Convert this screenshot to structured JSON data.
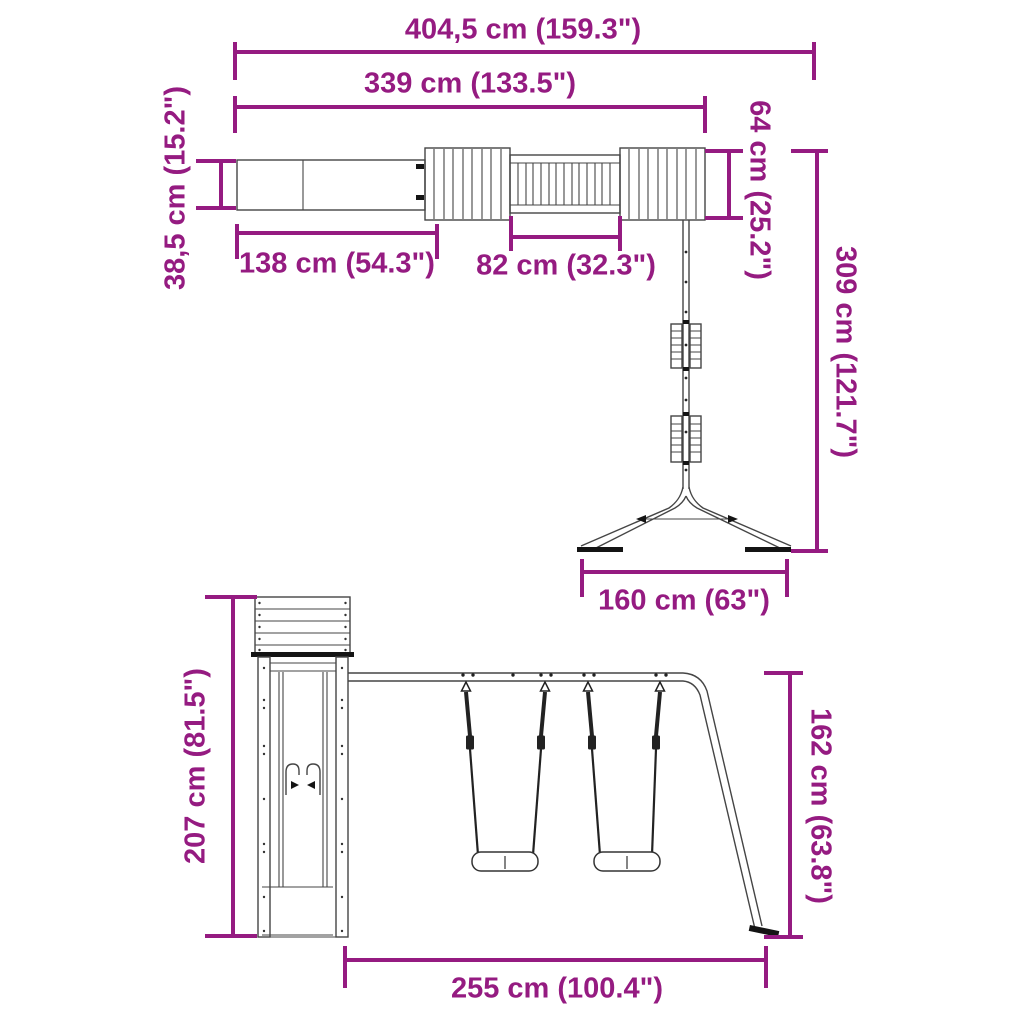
{
  "diagram": {
    "type": "product-dimension-diagram",
    "subject": "wooden playset with monkey-bar swing beam, slide tower and double swing set",
    "views": [
      "monkey-bar-beam-with-a-frame-side",
      "tower-slide-and-swing-set-front"
    ]
  },
  "colors": {
    "dimension": "#951b81",
    "structure": "#454545",
    "dark": "#141414",
    "background": "#ffffff"
  },
  "labels": {
    "total_width": "404,5 cm (159.3\")",
    "beam_span": "339 cm (133.5\")",
    "beam_depth": "38,5 cm (15.2\")",
    "left_beam_length": "138 cm (54.3\")",
    "bridge_length": "82 cm (32.3\")",
    "beam_thickness": "64 cm (25.2\")",
    "frame_height": "309 cm (121.7\")",
    "base_width": "160 cm (63\")",
    "tower_height": "207 cm (81.5\")",
    "swing_frame_height": "162 cm (63.8\")",
    "swing_frame_width": "255 cm (100.4\")"
  }
}
